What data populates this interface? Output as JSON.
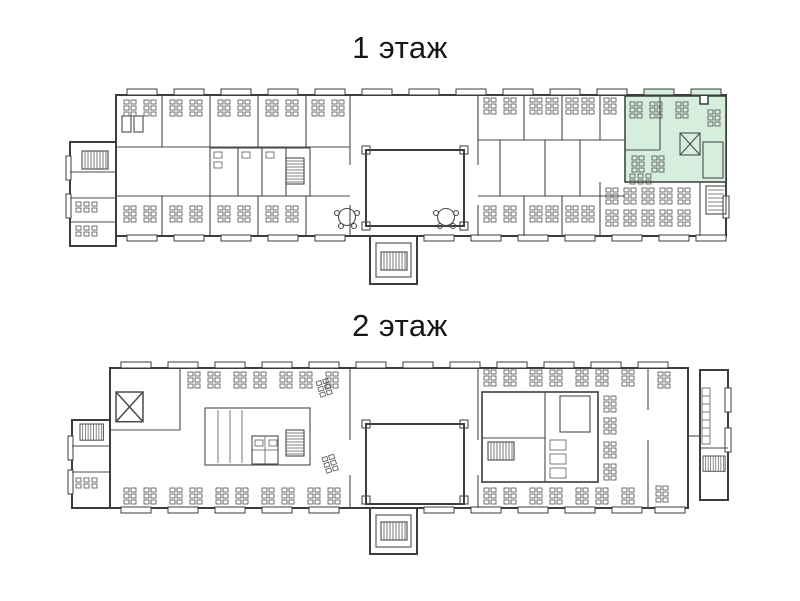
{
  "floors": [
    {
      "label": "1 этаж",
      "highlight": {
        "color": "#d5eedd",
        "location": "top-right section"
      }
    },
    {
      "label": "2 этаж"
    }
  ],
  "colors": {
    "background": "#ffffff",
    "walls": "#3c3c3c",
    "furniture": "#4f4f4f"
  }
}
